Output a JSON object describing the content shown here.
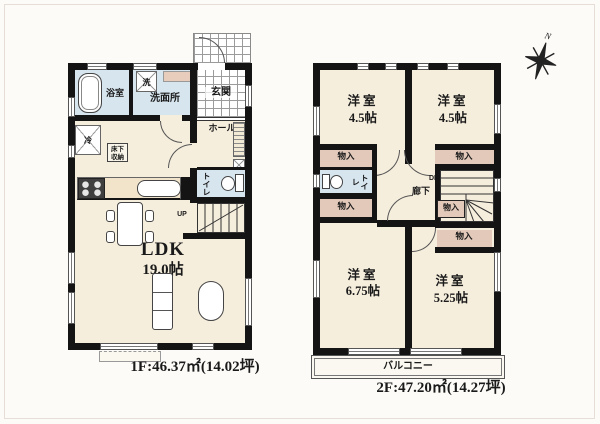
{
  "compass": {
    "north": "N"
  },
  "colors": {
    "wall": "#141414",
    "floor": "#f6eedd",
    "wet_area": "#d7e5ef",
    "closet": "#e2c9ba",
    "counter": "#e8cdbd",
    "background": "#fcfbf8"
  },
  "floor1": {
    "caption": "1F:46.37㎡(14.02坪)",
    "rooms": {
      "bath": "浴室",
      "washroom": "洗面所",
      "washer_mark": "洗",
      "fridge_mark": "冷",
      "entrance": "玄関",
      "hall": "ホール",
      "toilet": "トイレ",
      "underfloor_storage": "床下収納",
      "ldk_name": "LDK",
      "ldk_size": "19.0帖",
      "stairs_up": "UP"
    }
  },
  "floor2": {
    "caption": "2F:47.20㎡(14.27坪)",
    "bedrooms": [
      {
        "name": "洋室",
        "size": "4.5帖"
      },
      {
        "name": "洋室",
        "size": "4.5帖"
      },
      {
        "name": "洋室",
        "size": "6.75帖"
      },
      {
        "name": "洋室",
        "size": "5.25帖"
      }
    ],
    "rooms": {
      "closet": "物入",
      "toilet": "トイレ",
      "corridor": "廊下",
      "stairs_down": "DN",
      "balcony": "バルコニー"
    }
  }
}
